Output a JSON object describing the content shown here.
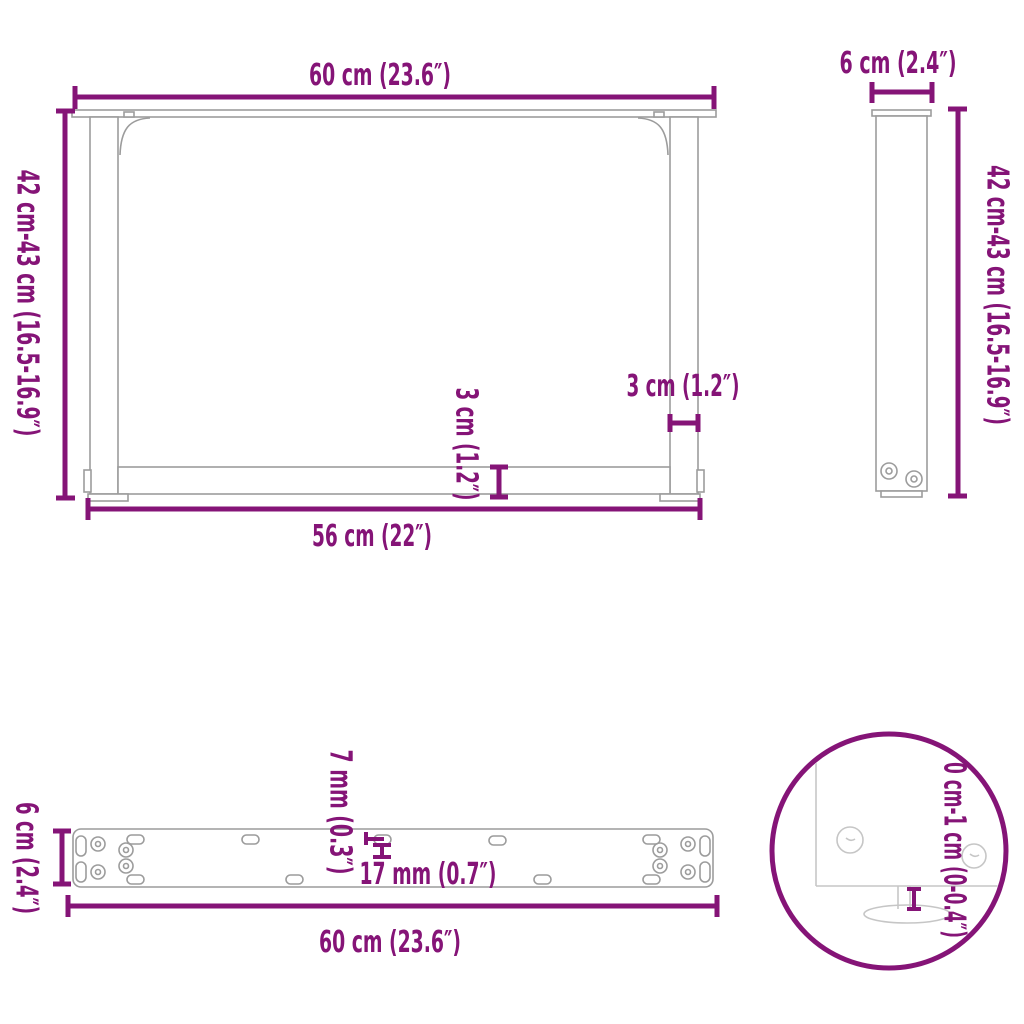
{
  "diagram_title": "Table leg dimension diagram",
  "colors": {
    "accent": "#851477",
    "outline": "#9c9c9c",
    "faint_outline": "#c6c6c6",
    "background": "#ffffff"
  },
  "views": {
    "front": {
      "top_width": "60 cm (23.6″)",
      "height": "42 cm-43 cm (16.5-16.9″)",
      "leg_thickness": "3 cm (1.2″)",
      "crossbar_thickness": "3 cm (1.2″)",
      "bottom_width": "56 cm (22″)"
    },
    "side": {
      "width": "6 cm (2.4″)",
      "height": "42 cm-43 cm (16.5-16.9″)"
    },
    "top": {
      "depth": "6 cm (2.4″)",
      "hole_width": "7 mm (0.3″)",
      "hole_length": "17 mm (0.7″)",
      "length": "60 cm (23.6″)"
    },
    "detail": {
      "adjustable_range": "0 cm-1 cm (0-0.4″)"
    }
  }
}
